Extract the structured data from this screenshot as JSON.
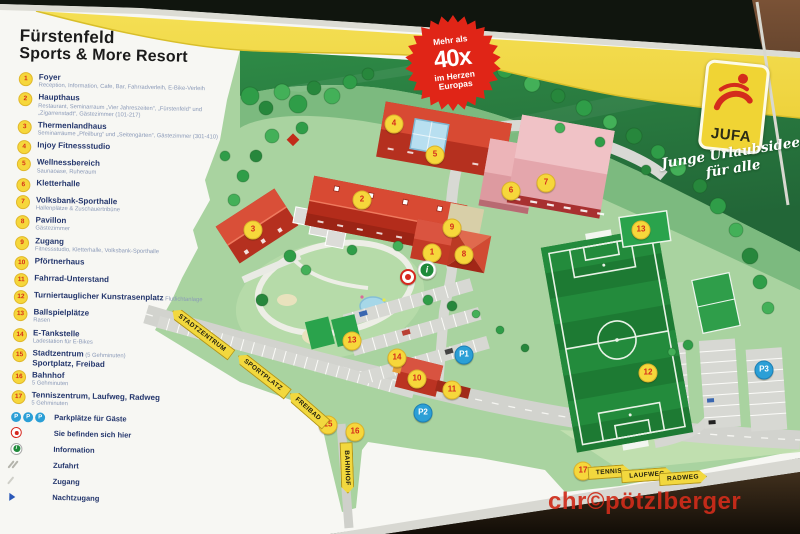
{
  "sign": {
    "title_line1": "Fürstenfeld",
    "title_line2": "Sports & More Resort",
    "badge": {
      "line1": "Mehr als",
      "line2": "40x",
      "line3": "im Herzen",
      "line4": "Europas"
    },
    "logo": {
      "name": "JUFA",
      "tagline_line1": "Junge Urlaubsidee",
      "tagline_line2": "für alle"
    },
    "watermark": "chr©pötzlberger"
  },
  "legend": {
    "items": [
      {
        "num": "1",
        "label": "Foyer",
        "sub": "Reception, Information, Cafe, Bar, Fahrradverleih, E-Bike-Verleih"
      },
      {
        "num": "2",
        "label": "Haupthaus",
        "sub": "Restaurant, Seminarraum „Vier Jahreszeiten“, „Fürstenfeld“ und „Zigarrenstadt“, Gästezimmer (101-217)"
      },
      {
        "num": "3",
        "label": "Thermenlandhaus",
        "sub": "Seminarräume „Pfeilburg“ und „Seitengärten“, Gästezimmer (301-410)"
      },
      {
        "num": "4",
        "label": "Injoy Fitnessstudio",
        "sub": ""
      },
      {
        "num": "5",
        "label": "Wellnessbereich",
        "sub": "Saunaoase, Ruheraum"
      },
      {
        "num": "6",
        "label": "Kletterhalle",
        "sub": ""
      },
      {
        "num": "7",
        "label": "Volksbank-Sporthalle",
        "sub": "Hallenplätze & Zuschauertribüne"
      },
      {
        "num": "8",
        "label": "Pavillon",
        "sub": "Gästezimmer"
      },
      {
        "num": "9",
        "label": "Zugang",
        "sub": "Fitnessstudio, Kletterhalle, Volksbank-Sporthalle"
      },
      {
        "num": "10",
        "label": "Pförtnerhaus",
        "sub": ""
      },
      {
        "num": "11",
        "label": "Fahrrad-Unterstand",
        "sub": ""
      },
      {
        "num": "12",
        "label": "Turniertauglicher Kunstrasenplatz",
        "note": "Flutlichtanlage",
        "sub": ""
      },
      {
        "num": "13",
        "label": "Ballspielplätze",
        "sub": "Rasen"
      },
      {
        "num": "14",
        "label": "E-Tankstelle",
        "sub": "Ladestation für E-Bikes"
      },
      {
        "num": "15",
        "label": "Stadtzentrum",
        "note": "(5 Gehminuten)",
        "label2": "Sportplatz, Freibad",
        "sub": ""
      },
      {
        "num": "16",
        "label": "Bahnhof",
        "sub": "5 Gehminuten"
      },
      {
        "num": "17",
        "label": "Tenniszentrum, Laufweg, Radweg",
        "sub": "5 Gehminuten"
      }
    ],
    "symbols": [
      {
        "type": "parking",
        "label": "Parkplätze für Gäste"
      },
      {
        "type": "here",
        "label": "Sie befinden sich hier"
      },
      {
        "type": "info",
        "label": "Information"
      },
      {
        "type": "zufahrt",
        "label": "Zufahrt"
      },
      {
        "type": "zugang",
        "label": "Zugang"
      },
      {
        "type": "nachtzugang",
        "label": "Nachtzugang"
      }
    ]
  },
  "map": {
    "markers": [
      {
        "label": "1",
        "x": 432,
        "y": 253,
        "type": "num"
      },
      {
        "label": "2",
        "x": 362,
        "y": 200,
        "type": "num"
      },
      {
        "label": "3",
        "x": 253,
        "y": 230,
        "type": "num"
      },
      {
        "label": "4",
        "x": 394,
        "y": 124,
        "type": "num"
      },
      {
        "label": "5",
        "x": 435,
        "y": 155,
        "type": "num"
      },
      {
        "label": "6",
        "x": 511,
        "y": 191,
        "type": "num"
      },
      {
        "label": "7",
        "x": 546,
        "y": 183,
        "type": "num"
      },
      {
        "label": "8",
        "x": 464,
        "y": 255,
        "type": "num"
      },
      {
        "label": "9",
        "x": 452,
        "y": 228,
        "type": "num"
      },
      {
        "label": "10",
        "x": 417,
        "y": 379,
        "type": "num"
      },
      {
        "label": "11",
        "x": 452,
        "y": 390,
        "type": "num"
      },
      {
        "label": "12",
        "x": 648,
        "y": 373,
        "type": "num"
      },
      {
        "label": "13",
        "x": 352,
        "y": 341,
        "type": "num"
      },
      {
        "label": "13",
        "x": 641,
        "y": 230,
        "type": "num"
      },
      {
        "label": "14",
        "x": 397,
        "y": 358,
        "type": "num"
      },
      {
        "label": "15",
        "x": 328,
        "y": 425,
        "type": "num"
      },
      {
        "label": "16",
        "x": 355,
        "y": 432,
        "type": "num"
      },
      {
        "label": "17",
        "x": 583,
        "y": 471,
        "type": "num"
      },
      {
        "label": "P1",
        "x": 464,
        "y": 355,
        "type": "p"
      },
      {
        "label": "P2",
        "x": 423,
        "y": 413,
        "type": "p"
      },
      {
        "label": "P3",
        "x": 764,
        "y": 370,
        "type": "p"
      },
      {
        "label": "",
        "x": 408,
        "y": 277,
        "type": "here"
      },
      {
        "label": "i",
        "x": 427,
        "y": 270,
        "type": "info"
      }
    ],
    "banners": [
      {
        "text": "STADTZENTRUM",
        "x": 202,
        "y": 333,
        "rot": 37,
        "tip": "left"
      },
      {
        "text": "SPORTPLATZ",
        "x": 263,
        "y": 375,
        "rot": 38,
        "tip": "left"
      },
      {
        "text": "FREIBAD",
        "x": 308,
        "y": 409,
        "rot": 41,
        "tip": "left"
      },
      {
        "text": "BAHNHOF",
        "x": 347,
        "y": 468,
        "rot": 88,
        "tip": "right"
      },
      {
        "text": "TENNIS",
        "x": 609,
        "y": 472,
        "rot": -4,
        "tip": "right"
      },
      {
        "text": "LAUFWEG",
        "x": 647,
        "y": 475,
        "rot": -4,
        "tip": "right"
      },
      {
        "text": "RADWEG",
        "x": 683,
        "y": 478,
        "rot": -4,
        "tip": "right"
      }
    ]
  }
}
